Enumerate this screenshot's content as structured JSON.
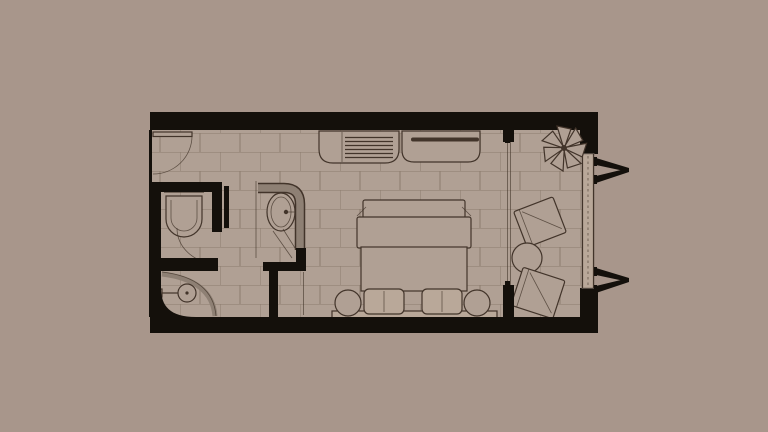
{
  "meta": {
    "figure_type": "architectural-floor-plan",
    "subject": "hotel-guest-room-with-bathroom-and-balcony",
    "visible_text": []
  },
  "colors": {
    "background": "#a8968b",
    "floor": "#b0a094",
    "grout": "#8b7b6e",
    "wall": "#14100b",
    "line": "#42342a",
    "band": "#8e8074",
    "fill_light": "#b9a899"
  },
  "rooms": [
    "entry-hall",
    "toilet-room",
    "shower-area",
    "bathtub-niche",
    "bedroom",
    "balcony"
  ],
  "fixtures": [
    "entry-door",
    "toilet",
    "toilet-door",
    "shower-head",
    "shower-screen",
    "bathtub",
    "bath-faucet",
    "luggage-bench",
    "desk-console",
    "double-bed",
    "bed-pillows",
    "headboard-panel",
    "nightstand-left",
    "nightstand-right",
    "sliding-glass-door",
    "balcony-plant",
    "balcony-chair-upper",
    "balcony-chair-lower",
    "balcony-round-table",
    "balcony-railing",
    "facade-bracket-top",
    "facade-bracket-bottom"
  ]
}
